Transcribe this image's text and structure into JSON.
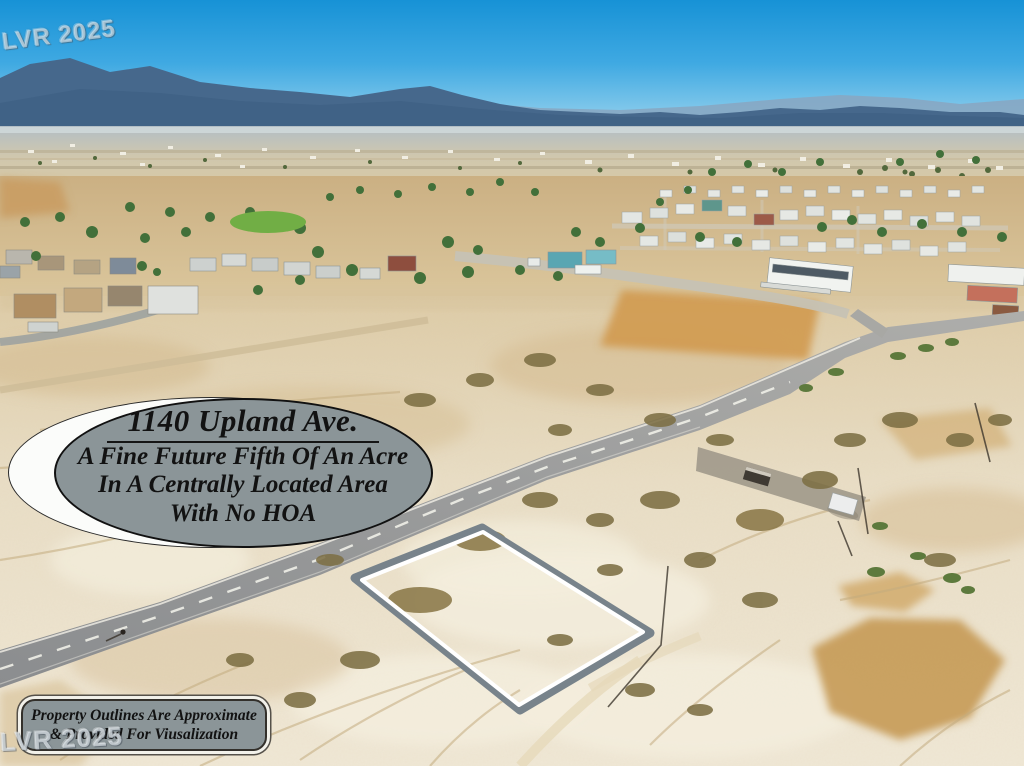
{
  "overlay": {
    "badge": {
      "title": "1140 Upland Ave.",
      "lines": [
        "A Fine Future Fifth Of An Acre",
        "In A Centrally Located Area",
        "With No HOA"
      ]
    },
    "disclaimer": {
      "lines": [
        "Property Outlines Are Approximate",
        "& Provided For Viusalization"
      ]
    },
    "watermarks": {
      "top_left": "LVR 2025",
      "bottom_left": "LVR 2025"
    }
  },
  "scene": {
    "type": "aerial-photo",
    "elements": [
      "blue sky",
      "desert mountain range",
      "hazy valley town",
      "neighborhood houses and trees",
      "paved road running diagonally",
      "vacant sand lot with white-and-gray property outline",
      "dry golden brush patches",
      "graded dirt pad with small shed",
      "cyclist on road"
    ]
  },
  "colors": {
    "sky_top": "#1792d6",
    "mountains": "#46688c",
    "sand": "#eadfc8",
    "dry_grass": "#c89a52",
    "road": "#96989a",
    "badge_fill": "#8b9598",
    "badge_backdrop": "#fbfcfa",
    "badge_text": "#121212",
    "property_outline_outer": "#78838b",
    "property_outline_inner": "#ffffff"
  }
}
